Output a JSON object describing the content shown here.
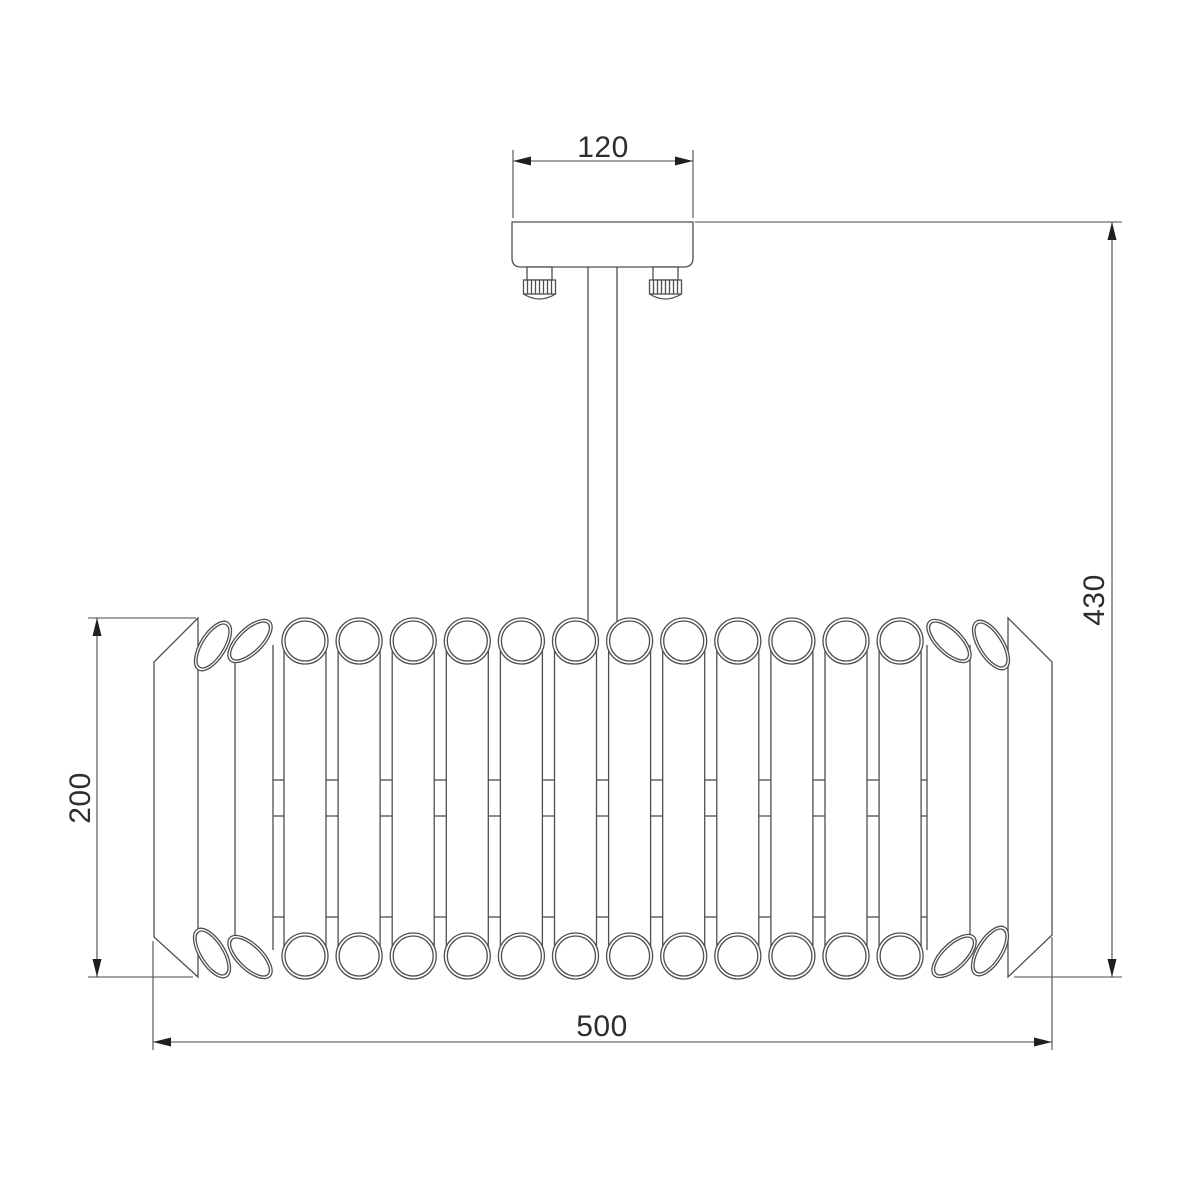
{
  "dimensions": {
    "canopy_width": {
      "label": "120"
    },
    "total_height": {
      "label": "430"
    },
    "body_height": {
      "label": "200"
    },
    "body_width": {
      "label": "500"
    }
  },
  "drawing": {
    "colors": {
      "line": "#4f4f4f",
      "dim_line": "#4a4a4a",
      "arrow": "#1f1f1f",
      "text": "#2d2d2d",
      "background": "#ffffff"
    },
    "canvas": {
      "width": 1200,
      "height": 1200
    },
    "canopy": {
      "x": 512,
      "y": 222,
      "width": 181,
      "height": 45,
      "corner_radius": 9
    },
    "screws": {
      "centers_x": [
        539.5,
        665.5
      ],
      "top_y": 267,
      "neck_width": 25,
      "neck_height": 13,
      "cap_width": 32,
      "cap_height": 14,
      "cap_arc_drop": 5,
      "knurl_count": 7
    },
    "stem": {
      "x_left": 588,
      "x_right": 617,
      "y_top": 267,
      "y_bottom": 640
    },
    "body": {
      "panels": {
        "left": {
          "inner_x": 198,
          "outer_x": 154,
          "inner_top": 618,
          "inner_bottom": 977,
          "outer_top": 662,
          "outer_bottom": 937
        },
        "right": {
          "inner_x": 1008,
          "outer_x": 1052,
          "inner_top": 618,
          "inner_bottom": 977,
          "outer_top": 662,
          "outer_bottom": 935
        }
      },
      "tubes": {
        "count": 12,
        "first_cx": 305,
        "spacing": 54.1,
        "top_cy": 641,
        "bottom_cy": 956,
        "outer_r": 23,
        "inner_r": 20,
        "side_dx": 21
      },
      "tilted_tubes": {
        "outer_rx": 28,
        "outer_ry": 13,
        "inner_rx": 25,
        "inner_ry": 10.5,
        "top": [
          {
            "cx": 213,
            "cy": 646,
            "rot": -58
          },
          {
            "cx": 250,
            "cy": 641,
            "rot": -44
          },
          {
            "cx": 991,
            "cy": 645,
            "rot": 58
          },
          {
            "cx": 949,
            "cy": 641,
            "rot": 44
          }
        ],
        "bottom": [
          {
            "cx": 212,
            "cy": 953,
            "rot": 58
          },
          {
            "cx": 250,
            "cy": 957,
            "rot": 44
          },
          {
            "cx": 990,
            "cy": 951,
            "rot": -58
          },
          {
            "cx": 954,
            "cy": 956,
            "rot": -44
          }
        ],
        "side_lines_x": [
          235,
          273,
          927,
          970
        ],
        "side_top": 645,
        "side_bottom": 950
      },
      "gap_ticks": {
        "mid_ys": [
          780,
          816
        ],
        "low_y": 917,
        "extra_gaps": [
          [
            273,
            284
          ],
          [
            921,
            927
          ]
        ]
      }
    },
    "dims": {
      "canopy_width": {
        "ext": [
          [
            513,
            150,
            513,
            218
          ],
          [
            693,
            150,
            693,
            218
          ]
        ],
        "line": [
          513,
          161,
          693,
          161
        ],
        "arrows": [
          [
            "left",
            513,
            161
          ],
          [
            "right",
            693,
            161
          ]
        ],
        "label_anchor": [
          603,
          157
        ],
        "label_rotate": 0
      },
      "total_height": {
        "ext": [
          [
            695,
            222,
            1122,
            222
          ],
          [
            1014,
            977,
            1122,
            977
          ]
        ],
        "line": [
          1112,
          222,
          1112,
          977
        ],
        "arrows": [
          [
            "up",
            1112,
            222
          ],
          [
            "down",
            1112,
            977
          ]
        ],
        "label_anchor": [
          1104,
          600
        ],
        "label_rotate": -90
      },
      "body_height": {
        "ext": [
          [
            88,
            618,
            196,
            618
          ],
          [
            88,
            977,
            193,
            977
          ]
        ],
        "line": [
          97,
          618,
          97,
          977
        ],
        "arrows": [
          [
            "up",
            97,
            618
          ],
          [
            "down",
            97,
            977
          ]
        ],
        "label_anchor": [
          90,
          798
        ],
        "label_rotate": -90
      },
      "body_width": {
        "ext": [
          [
            153,
            941,
            153,
            1050
          ],
          [
            1052,
            937,
            1052,
            1050
          ]
        ],
        "line": [
          153,
          1042,
          1052,
          1042
        ],
        "arrows": [
          [
            "left",
            153,
            1042
          ],
          [
            "right",
            1052,
            1042
          ]
        ],
        "label_anchor": [
          602,
          1036
        ],
        "label_rotate": 0
      }
    }
  }
}
